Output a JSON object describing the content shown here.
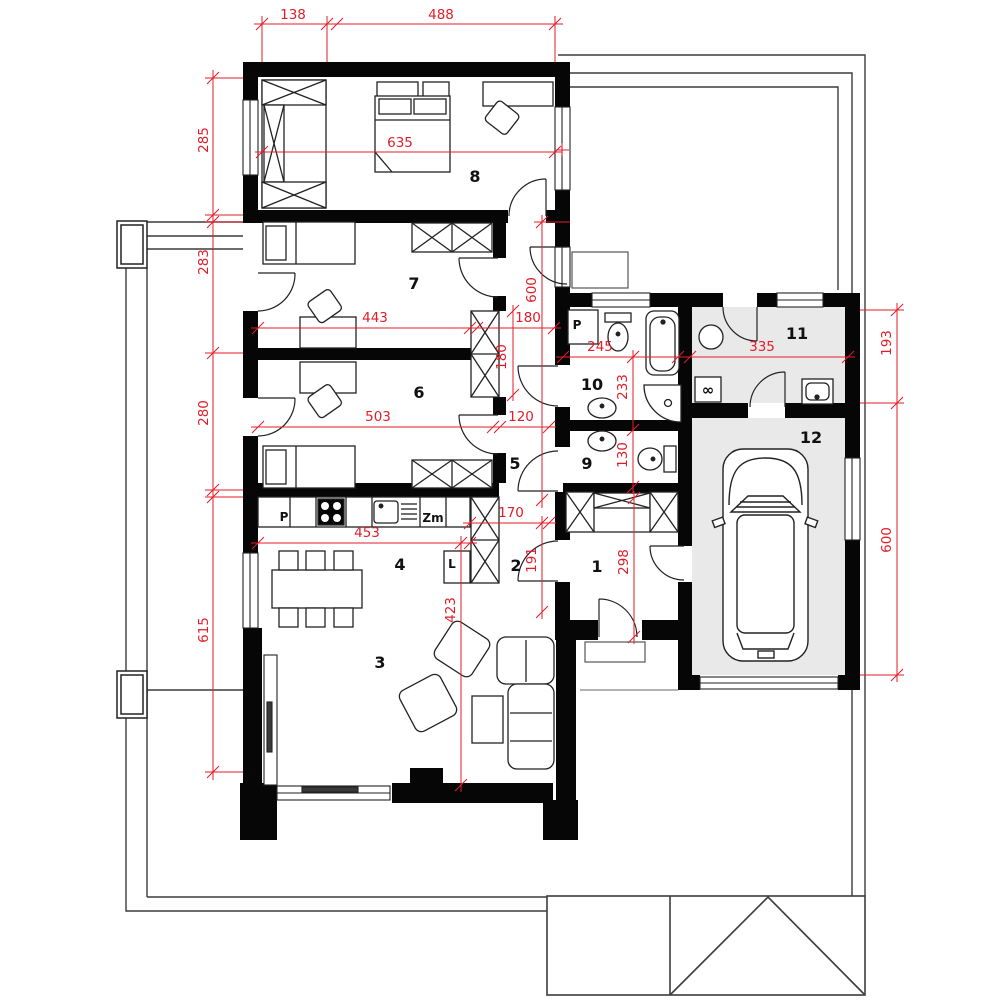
{
  "dimensions": [
    {
      "name": "top-left-offset",
      "value": "138"
    },
    {
      "name": "top-house-width",
      "value": "488"
    },
    {
      "name": "left-room8-depth",
      "value": "285"
    },
    {
      "name": "left-room7-depth",
      "value": "283"
    },
    {
      "name": "left-room6-depth",
      "value": "280"
    },
    {
      "name": "left-living-depth",
      "value": "615"
    },
    {
      "name": "room8-width",
      "value": "635"
    },
    {
      "name": "room7-width",
      "value": "443"
    },
    {
      "name": "corridor-niche-width",
      "value": "180"
    },
    {
      "name": "corridor-niche-depth",
      "value": "180"
    },
    {
      "name": "hallway-length",
      "value": "600"
    },
    {
      "name": "room6-width",
      "value": "503"
    },
    {
      "name": "room6-corridor",
      "value": "120"
    },
    {
      "name": "kitchen-width",
      "value": "453"
    },
    {
      "name": "pantry-width",
      "value": "170"
    },
    {
      "name": "pantry-depth",
      "value": "191"
    },
    {
      "name": "hall1-depth",
      "value": "298"
    },
    {
      "name": "living-room-depth",
      "value": "423"
    },
    {
      "name": "bathroom-width",
      "value": "245"
    },
    {
      "name": "bathroom-depth",
      "value": "233"
    },
    {
      "name": "wc-depth",
      "value": "130"
    },
    {
      "name": "utility-width",
      "value": "335"
    },
    {
      "name": "right-utility-depth",
      "value": "193"
    },
    {
      "name": "right-garage-depth",
      "value": "600"
    }
  ],
  "rooms": [
    {
      "number": "1"
    },
    {
      "number": "2"
    },
    {
      "number": "3"
    },
    {
      "number": "4"
    },
    {
      "number": "5"
    },
    {
      "number": "6"
    },
    {
      "number": "7"
    },
    {
      "number": "8"
    },
    {
      "number": "9"
    },
    {
      "number": "10"
    },
    {
      "number": "11"
    },
    {
      "number": "12"
    }
  ],
  "labels": {
    "bath_washer": "P",
    "kitchen_appliance": "P",
    "dishwasher": "Zm",
    "fridge": "L",
    "laundry_symbol": "∞"
  },
  "colors": {
    "dimension_red": "#e21d2a",
    "wall_black": "#060606",
    "garage_floor_gray": "#e9e9e9"
  }
}
